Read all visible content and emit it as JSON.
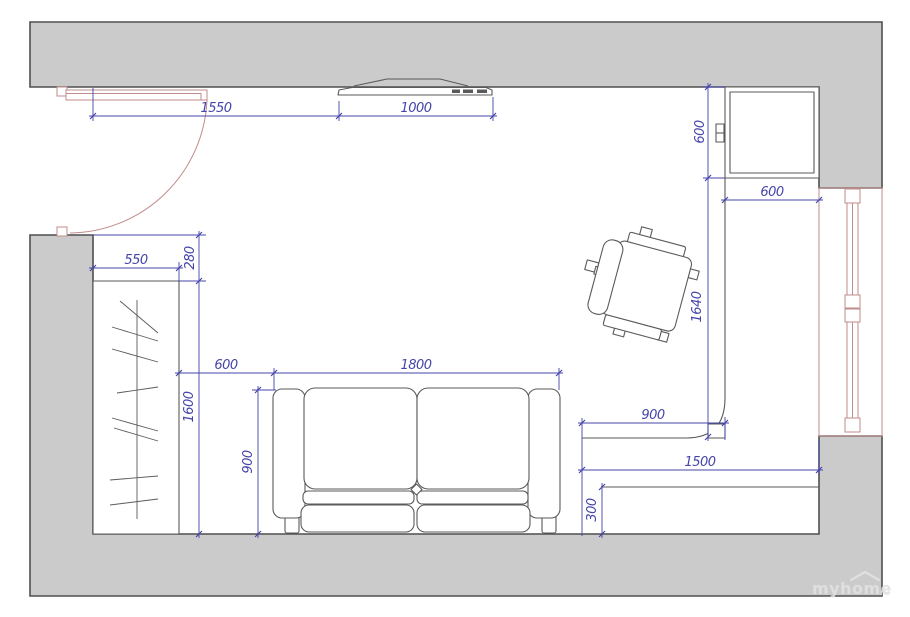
{
  "floorplan": {
    "watermark": {
      "text": "myhome",
      "suffix": "ru"
    },
    "dims": {
      "door_clearance": "1550",
      "tv_width": "1000",
      "cabinet_depth": "600",
      "cabinet_width": "600",
      "wardrobe_width": "550",
      "wardrobe_offset": "280",
      "wardrobe_length": "1600",
      "sofa_gap": "600",
      "sofa_width": "1800",
      "sofa_depth": "900",
      "counter_length": "1640",
      "counter_return": "900",
      "lowboard_width": "1500",
      "lowboard_depth": "300"
    },
    "furniture": [
      "entry-door",
      "mirrored-wardrobe",
      "sofa",
      "armchair",
      "tv-shelf",
      "wall-cabinet",
      "corner-counter",
      "low-cabinet",
      "window"
    ],
    "colors": {
      "wall_fill": "#cbcbcb",
      "wall_stroke": "#4f4f4f",
      "dim_color": "#4444aa",
      "opening_color": "#c08b8b",
      "furniture_stroke": "#5a5a5a",
      "watermark_color": "#e2e2e2"
    }
  }
}
